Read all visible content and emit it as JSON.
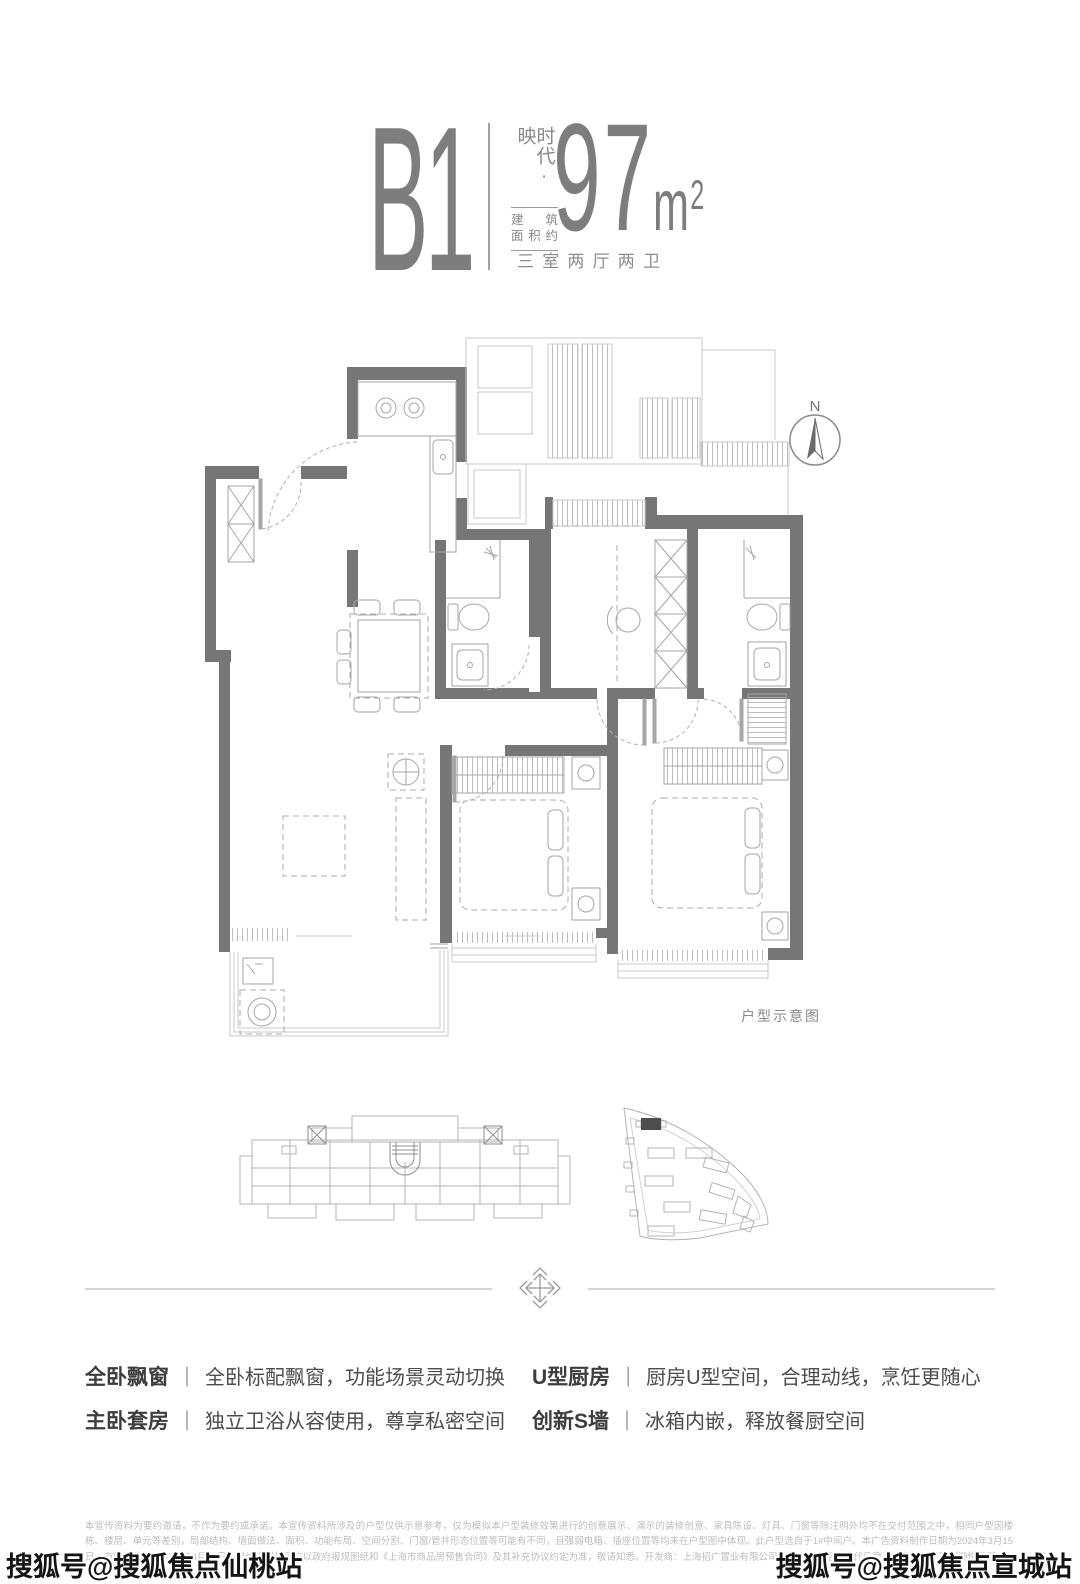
{
  "header": {
    "unit": "B1",
    "brand": "时代·映",
    "area_label_line1": "建筑",
    "area_label_line2": "面积约",
    "area_value": "97",
    "area_unit_base": "m",
    "area_unit_sup": "2",
    "layout": "三室两厅两卫"
  },
  "plan": {
    "compass_label": "N",
    "caption": "户型示意图"
  },
  "features_separator": "｜",
  "features": [
    {
      "label": "全卧飘窗",
      "desc": "全卧标配飘窗，功能场景灵动切换"
    },
    {
      "label": "主卧套房",
      "desc": "独立卫浴从容使用，尊享私密空间"
    },
    {
      "label": "U型厨房",
      "desc": "厨房U型空间，合理动线，烹饪更随心"
    },
    {
      "label": "创新S墙",
      "desc": "冰箱内嵌，释放餐厨空间"
    }
  ],
  "footer": {
    "disclaimer": "本宣传资料为要约邀请，不作为要约或承诺。本宣传资料所涉及的户型仅供示意参考，仅为模拟本户型装修效果进行的创意展示、演示的装修创意、家具陈设、灯具、门窗等除注明外均不在交付范围之中，相同户型因楼栋、楼层、单元等差别，局部结构、墙面做法、面积、功能布局、空间分割、门窗/管井形态位置等可能有不同，且强弱电箱、插座位置等均未在户型图中体现。此户型选自于1#中间户。本广告资料制作日期为2024年3月15日，有效期截止至2024年4月15日，最终户型信息应以政府报规图纸和《上海市商品房预售合同》及其补充协议约定为准，敬请知悉。开发商：上海招广置业有限公司，推广名：招商时代乐章，备案名：新顾城瀚悦名邸。"
  },
  "watermarks": {
    "left": "搜狐号@搜狐焦点仙桃站",
    "right": "搜狐号@搜狐焦点宣城站"
  },
  "colors": {
    "accent_gray": "#7e7d7b",
    "wall_gray": "#767676",
    "light_line": "#c9c9c9",
    "highlight_building": "#4e4e4e",
    "disclaimer_gray": "#bdbdbd"
  }
}
